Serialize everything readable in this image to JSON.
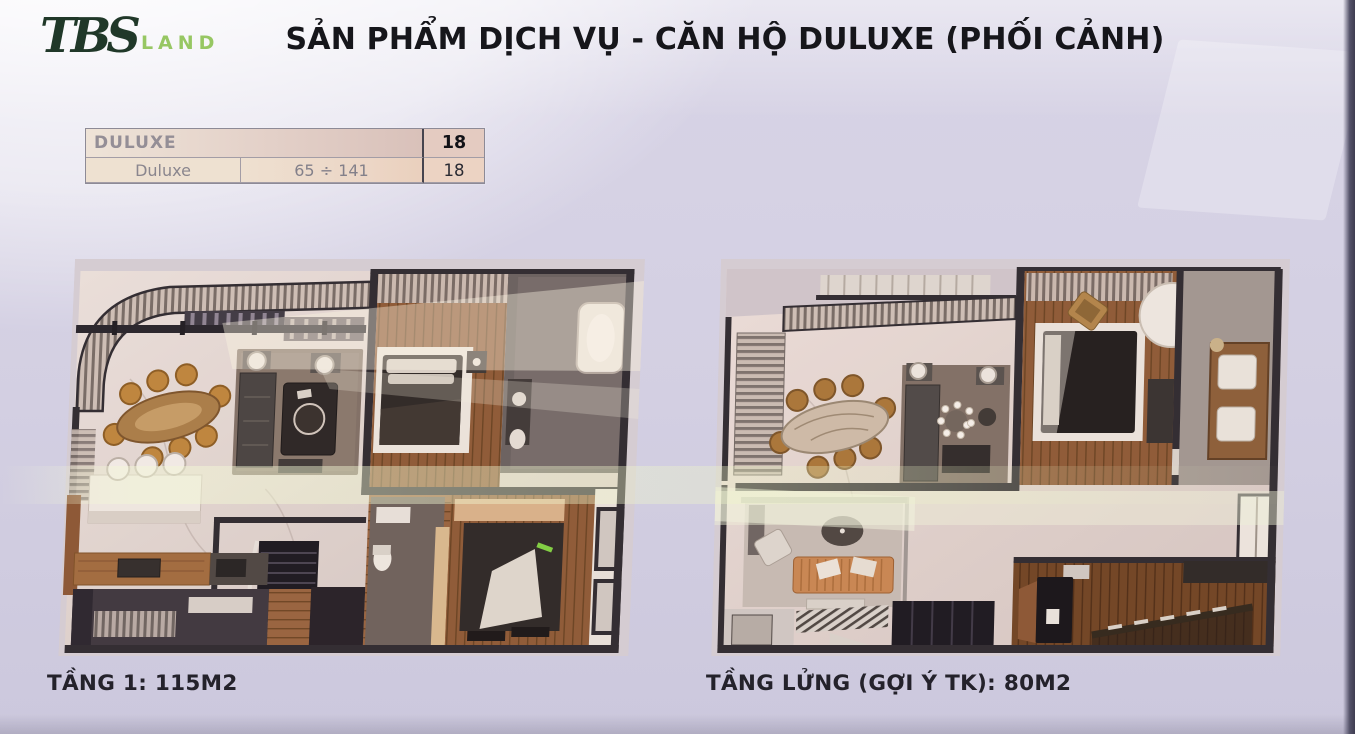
{
  "page": {
    "background_color": "#d3cfe1",
    "photo_edge_color": "#4e4c5c"
  },
  "header": {
    "logo": {
      "tbs": "TBS",
      "land": "LAND",
      "tbs_color": "#203829",
      "land_color": "#97c763"
    },
    "title": "SẢN PHẨM DỊCH VỤ - CĂN HỘ DULUXE (PHỐI CẢNH)"
  },
  "summary_table": {
    "header": {
      "product": "DULUXE",
      "count": "18"
    },
    "row": {
      "product": "Duluxe",
      "area_range": "65 ÷ 141",
      "count": "18"
    }
  },
  "floor_plans": [
    {
      "caption": "TẦNG 1: 115M2"
    },
    {
      "caption": "TẦNG LỬNG (GỢI Ý TK): 80M2"
    }
  ]
}
